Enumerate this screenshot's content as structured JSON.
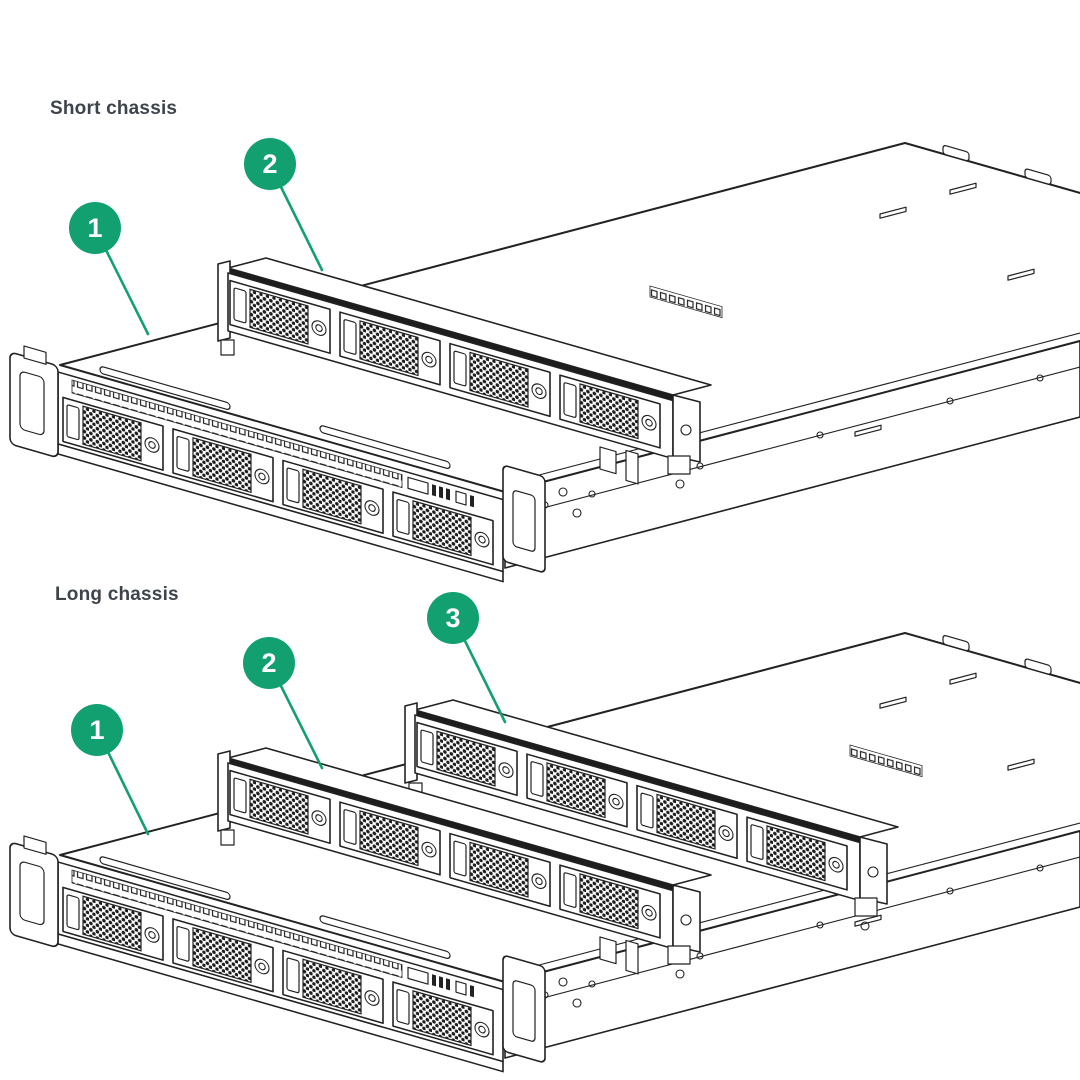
{
  "page": {
    "background_color": "#ffffff"
  },
  "colors": {
    "callout_green": "#12a070",
    "line_color": "#222222",
    "title_color": "#3e444b"
  },
  "figures": [
    {
      "id": "short-chassis",
      "title": "Short chassis",
      "callouts": [
        {
          "label": "1"
        },
        {
          "label": "2"
        }
      ]
    },
    {
      "id": "long-chassis",
      "title": "Long chassis",
      "callouts": [
        {
          "label": "1"
        },
        {
          "label": "2"
        },
        {
          "label": "3"
        }
      ]
    }
  ]
}
